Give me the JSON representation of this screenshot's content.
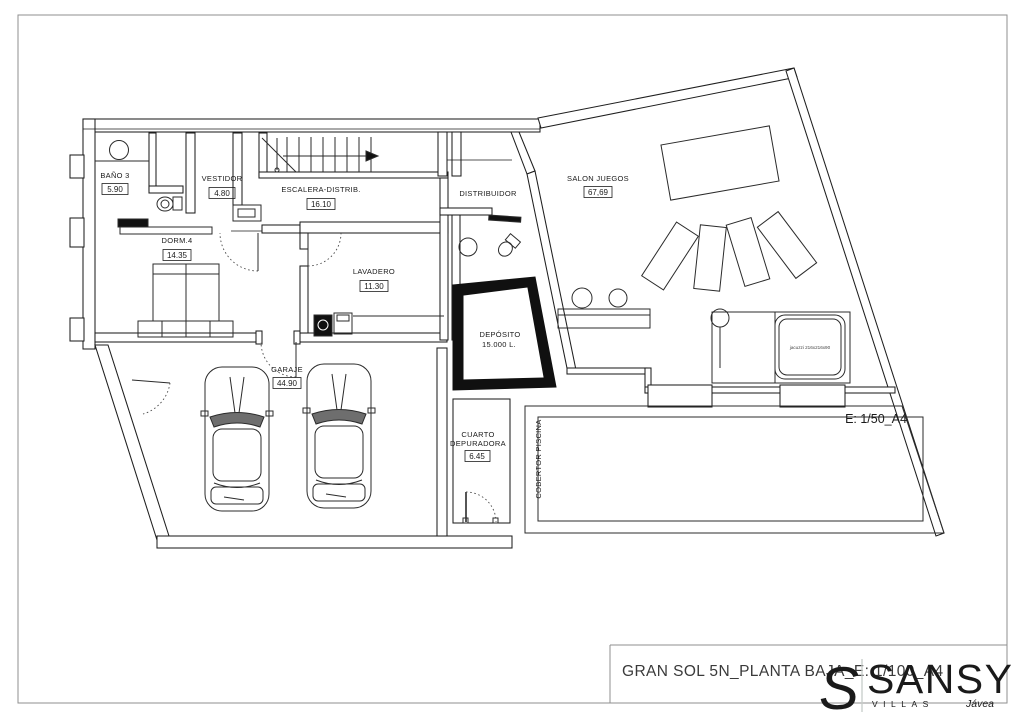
{
  "document": {
    "title": "GRAN SOL 5N_PLANTA BAJA_E: 1/100_A4"
  },
  "logo": {
    "initial": "S",
    "brand": "SANSY",
    "tagline": "VILLAS",
    "location": "Jávea",
    "gray": "#c7cbc8",
    "orange": "#d09a4c"
  },
  "plan": {
    "ink": "#1f1f1f",
    "rooms": [
      {
        "id": "banyo3",
        "name": "BAÑO 3",
        "area": "5.90"
      },
      {
        "id": "vestidor",
        "name": "VESTIDOR",
        "area": "4.80"
      },
      {
        "id": "escalera",
        "name": "ESCALERA-DISTRIB.",
        "area": "16.10"
      },
      {
        "id": "dorm4",
        "name": "DORM.4",
        "area": "14.35"
      },
      {
        "id": "lavadero",
        "name": "LAVADERO",
        "area": "11.30"
      },
      {
        "id": "distribuidor",
        "name": "DISTRIBUIDOR"
      },
      {
        "id": "salon-juegos",
        "name": "SALON JUEGOS",
        "area": "67,69"
      },
      {
        "id": "garaje",
        "name": "GARAJE",
        "area": "44.90"
      },
      {
        "id": "cuarto-depuradora",
        "name_line1": "CUARTO",
        "name_line2": "DEPURADORA",
        "area": "6.45"
      },
      {
        "id": "deposito",
        "name": "DEPÓSITO",
        "capacity": "15.000 L."
      }
    ],
    "annotations": {
      "pool_cover": "COBERTOR PISCINA",
      "pool_scale": "E: 1/50_A4",
      "jacuzzi": "jacuzzi 216x216x90"
    }
  }
}
